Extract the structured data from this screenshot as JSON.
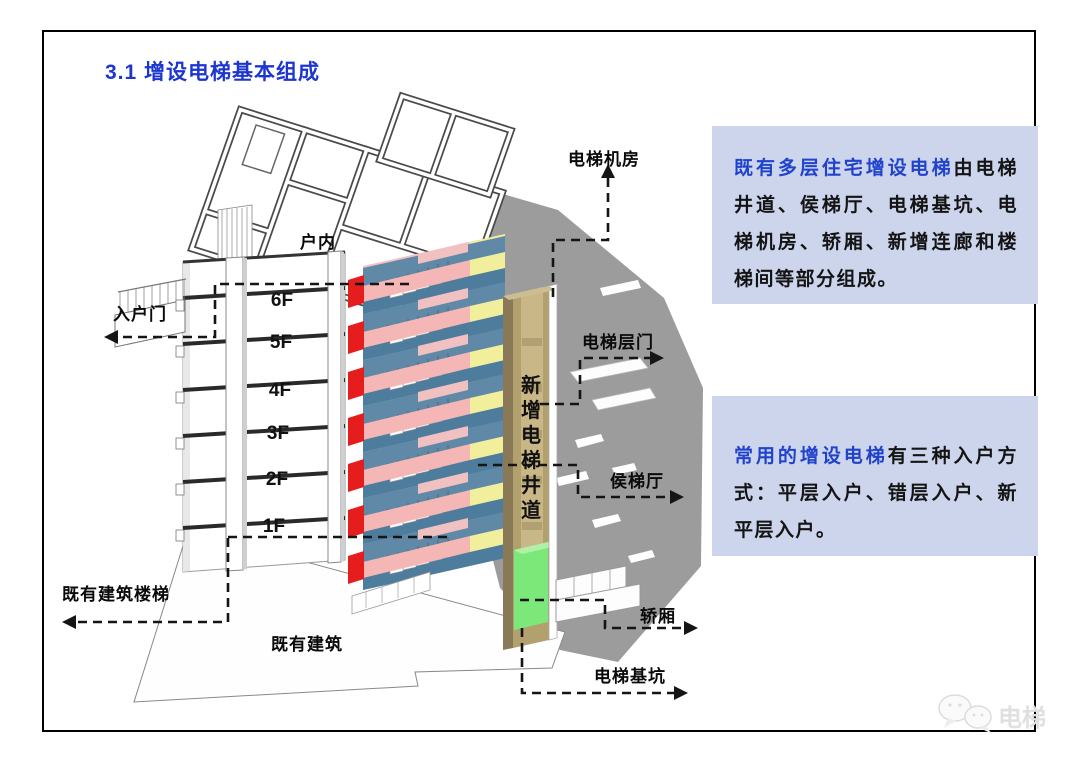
{
  "page": {
    "title": "3.1 增设电梯基本组成"
  },
  "info_boxes": [
    {
      "highlight": "既有多层住宅增设电梯",
      "body": "由电梯井道、侯梯厅、电梯基坑、电梯机房、轿厢、新增连廊和楼梯间等部分组成。"
    },
    {
      "highlight": "常用的增设电梯",
      "body": "有三种入户方式：平层入户、错层入户、新平层入户。"
    }
  ],
  "diagram": {
    "labels": {
      "indoor": "户内",
      "entrance_door": "入户门",
      "machine_room": "电梯机房",
      "landing_door": "电梯层门",
      "waiting_hall": "侯梯厅",
      "car": "轿厢",
      "pit": "电梯基坑",
      "existing_stairs": "既有建筑楼梯",
      "existing_building": "既有建筑"
    },
    "floors": [
      "6F",
      "5F",
      "4F",
      "3F",
      "2F",
      "1F"
    ],
    "shaft_chars": [
      "新",
      "增",
      "电",
      "梯",
      "井",
      "道"
    ],
    "colors": {
      "accent_blue": "#1c36cf",
      "box_bg": "#ccd5ec",
      "cut_wall_red": "#e51d1d",
      "landing_pink": "#f5b6b6",
      "stairwell_blue": "#5f89a7",
      "corridor_yellow": "#f1ef9b",
      "shaft_tan": "#b2a06f",
      "car_green": "#7ce87a",
      "shadow_gray": "#9c9c9c"
    }
  },
  "watermark": {
    "text": "电梯"
  }
}
